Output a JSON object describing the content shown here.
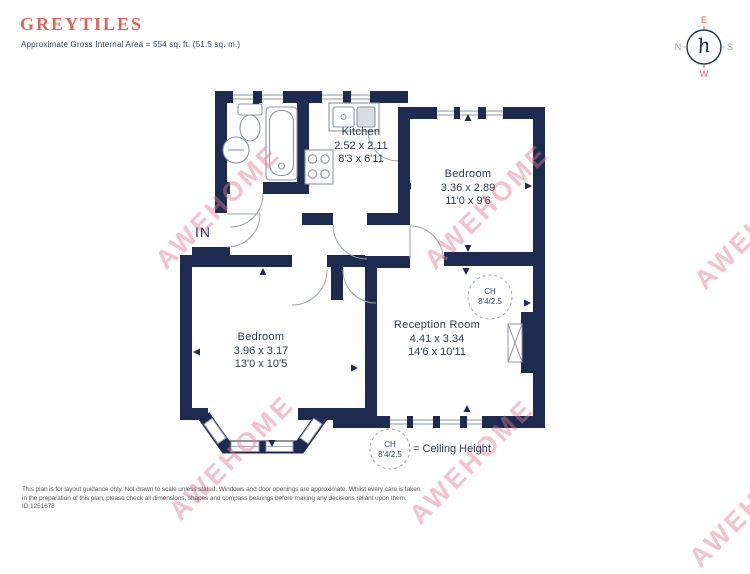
{
  "header": {
    "title": "GREYTILES",
    "subtitle": "Approximate Gross Internal Area = 554 sq. ft. (51.5 sq. m.)"
  },
  "compass": {
    "north": "N",
    "east": "E",
    "south": "S",
    "west": "W",
    "logo": "h"
  },
  "entrance": {
    "label": "IN"
  },
  "rooms": {
    "kitchen": {
      "name": "Kitchen",
      "metric": "2.52 x 2.11",
      "imperial": "8'3 x 6'11"
    },
    "bedroom_top": {
      "name": "Bedroom",
      "metric": "3.36 x 2.89",
      "imperial": "11'0 x 9'6"
    },
    "bedroom_left": {
      "name": "Bedroom",
      "metric": "3.96 x 3.17",
      "imperial": "13'0 x 10'5"
    },
    "reception": {
      "name": "Reception Room",
      "metric": "4.41 x 3.34",
      "imperial": "14'6 x 10'11"
    }
  },
  "ceiling_height_marker": {
    "abbr": "CH",
    "value": "8'4/2.5"
  },
  "legend": {
    "abbr": "CH",
    "value": "8'4/2.5",
    "text": "= Ceiling Height"
  },
  "watermark": {
    "text": "AWEHOME"
  },
  "footer": {
    "line1": "This plan is for layout guidance only. Not drawn to scale unless stated. Windows and door openings are approximate. Whilst every care is taken",
    "line2": "in the preparation of this plan, please check all dimensions, shapes and compass bearings before making any decisions reliant upon them.",
    "id": "ID 1251678"
  },
  "colors": {
    "wall": "#1c2b4f",
    "accent": "#e2635a",
    "watermark": "#e87e93",
    "label_text": "#2e3b54"
  }
}
